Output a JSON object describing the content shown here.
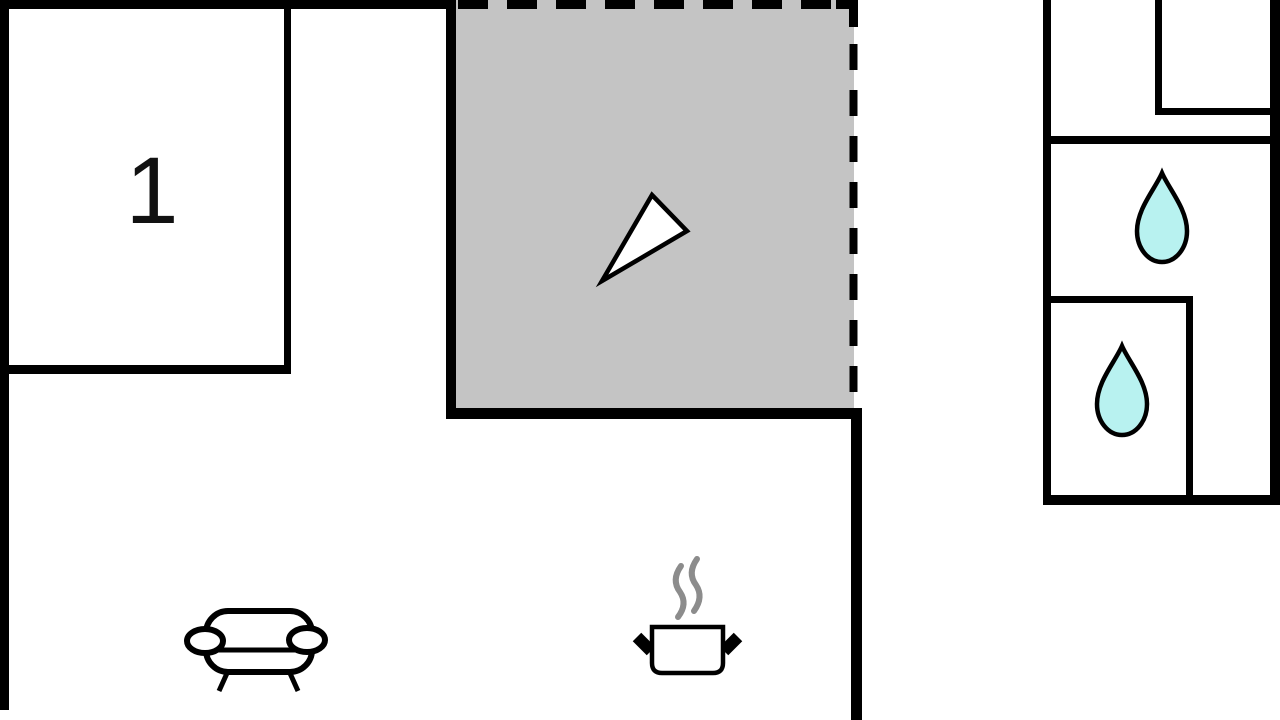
{
  "floor_plan": {
    "areas": [
      {
        "name": "bedroom-1",
        "label": "1"
      },
      {
        "name": "terrace",
        "features": [
          "north-arrow-icon"
        ]
      },
      {
        "name": "living-kitchen",
        "features": [
          "sofa-icon",
          "cooking-pot-icon",
          "steam-icon"
        ]
      },
      {
        "name": "bathroom",
        "features": [
          "water-droplet-icon",
          "water-droplet-icon"
        ]
      }
    ],
    "colors": {
      "background": "#ffffff",
      "wall": "#000000",
      "terrace_fill": "#c4c4c4",
      "droplet_fill": "#b8f2f0",
      "droplet_stroke": "#000000",
      "steam": "#8c8c8c",
      "arrow_fill": "#ffffff"
    }
  }
}
